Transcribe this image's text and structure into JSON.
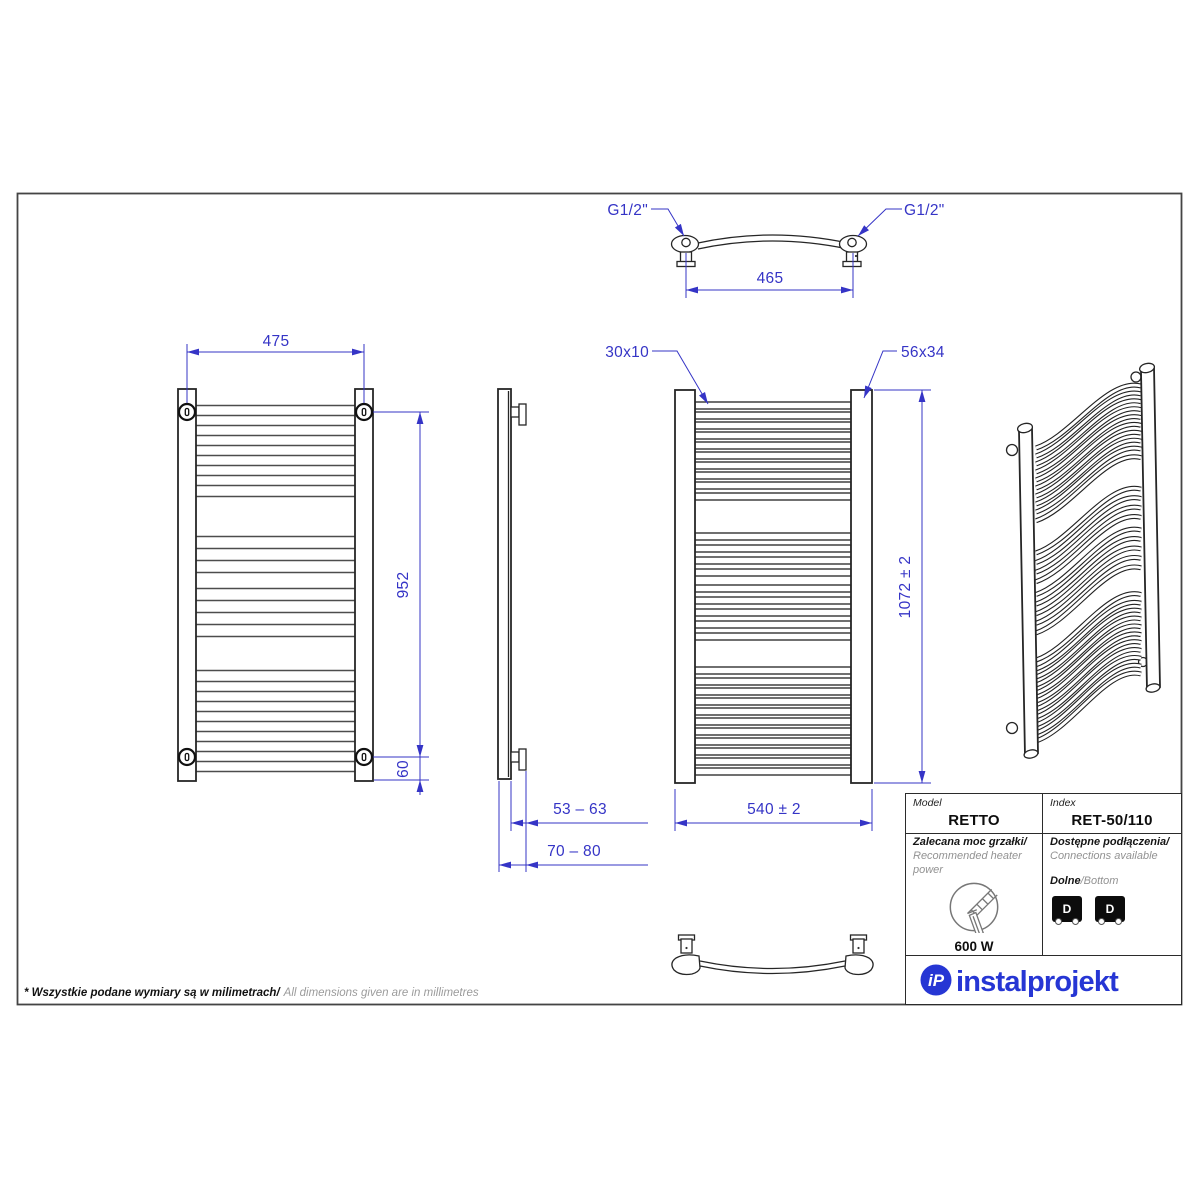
{
  "colors": {
    "dimension_blue": "#3534c6",
    "logo_blue": "#2636d4",
    "line_black": "#262626"
  },
  "dimensions": {
    "thread_left": "G1/2\"",
    "thread_right": "G1/2\"",
    "connection_spacing": "465",
    "mount_width": "475",
    "mount_height": "952",
    "bottom_offset": "60",
    "wall_distance_min": "53 – 63",
    "wall_distance_max": "70 – 80",
    "tube_profile": "30x10",
    "rail_profile": "56x34",
    "total_height": "1072 ± 2",
    "total_width": "540 ± 2"
  },
  "table": {
    "model_label": "Model",
    "model_value": "RETTO",
    "index_label": "Index",
    "index_value": "RET-50/110",
    "power_label_pl": "Zalecana moc grzałki/",
    "power_label_en": "Recommended heater power",
    "power_value": "600 W",
    "connections_label_pl": "Dostępne podłączenia/",
    "connections_label_en": "Connections available",
    "connection_type_pl": "Dolne",
    "connection_type_en": "/Bottom",
    "connection_icon_letter": "D"
  },
  "logo": {
    "icon": "iP",
    "text": "instalprojekt"
  },
  "footnote": {
    "pl": "* Wszystkie podane wymiary są w milimetrach/",
    "en": "All dimensions given are in millimetres"
  },
  "drawing": {
    "rung_tops": [
      402,
      412,
      422,
      432,
      442,
      452,
      462,
      472,
      482,
      493,
      533,
      545,
      557,
      569,
      585,
      597,
      609,
      621,
      633,
      667,
      678,
      688,
      698,
      708,
      718,
      728,
      738,
      748,
      758,
      768
    ]
  }
}
